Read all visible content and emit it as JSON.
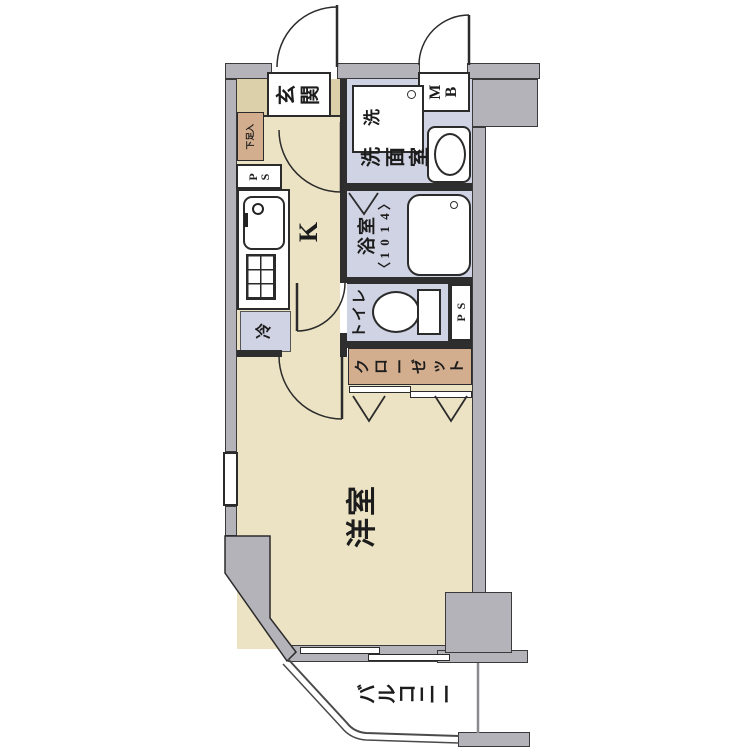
{
  "plan": {
    "type": "apartment-floor-plan",
    "rooms": {
      "genkan": {
        "label": "玄関"
      },
      "shoe_box": {
        "label": "下足入"
      },
      "ps_left": {
        "label": "PS"
      },
      "kitchen": {
        "label": "K"
      },
      "fridge": {
        "label": "冷"
      },
      "washer": {
        "label": "洗"
      },
      "meter_box": {
        "label": "MB"
      },
      "washroom": {
        "label": "洗面室"
      },
      "bath": {
        "label": "浴室",
        "size": "〈1014〉"
      },
      "toilet": {
        "label": "トイレ"
      },
      "ps_right": {
        "label": "PS"
      },
      "closet": {
        "label": "クローゼット"
      },
      "western_room": {
        "label": "洋室"
      },
      "balcony": {
        "label": "バルコニー"
      }
    },
    "colors": {
      "floor_beige": "#ece3c4",
      "genkan_tan": "#dbd0a9",
      "wet_area_blue": "#d0d3e3",
      "closet_brown": "#d2ad8e",
      "wall_gray": "#b3b3b9",
      "outline": "#2b2b2b",
      "background": "#ffffff"
    }
  }
}
